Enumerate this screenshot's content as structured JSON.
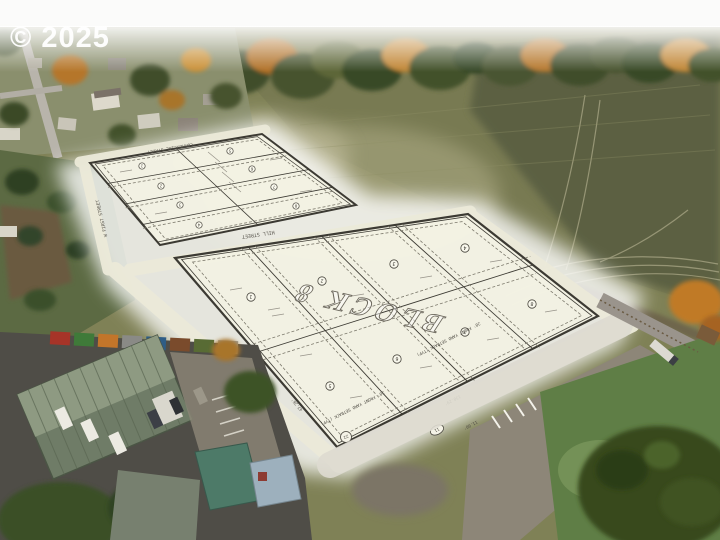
{
  "watermark": {
    "text": "© 2025"
  },
  "plat": {
    "block_title": "BLOCK 8",
    "streets": {
      "hill": "HILL STREET",
      "first": "W FIRST STREET",
      "commercial": "COMMERCIAL STREET"
    },
    "lower_block": {
      "lots": [
        "1",
        "2",
        "3",
        "4",
        "5",
        "6",
        "7",
        "8"
      ],
      "setback_note": "20' FRONT YARD SETBACK (TYP)",
      "dim_bottom": "130.29'",
      "dim_left": "47.26'",
      "dim_right": "11.00'",
      "curve_labels": [
        "22",
        "11"
      ]
    },
    "upper_block": {
      "lots": [
        "1",
        "2",
        "3",
        "4",
        "5",
        "6",
        "7",
        "8"
      ]
    }
  },
  "scene": {
    "description": "Autumn aerial drone photo of a subdivision site; two plat blocks highlighted white over fields, neighborhood top-left, warehouse yard bottom-left, farm field top-right",
    "colors": {
      "field": "#7f8156",
      "field_dark": "#5c6043",
      "plat_paper": "#f3f1e3",
      "plat_line": "#3c3a33",
      "highlight": "#ffffff",
      "asphalt": "#4f4d47",
      "warehouse_roof": "#7c8874",
      "teal_roof": "#4d7a68",
      "grass": "#5f7e46",
      "autumn": "#b5762b"
    }
  }
}
